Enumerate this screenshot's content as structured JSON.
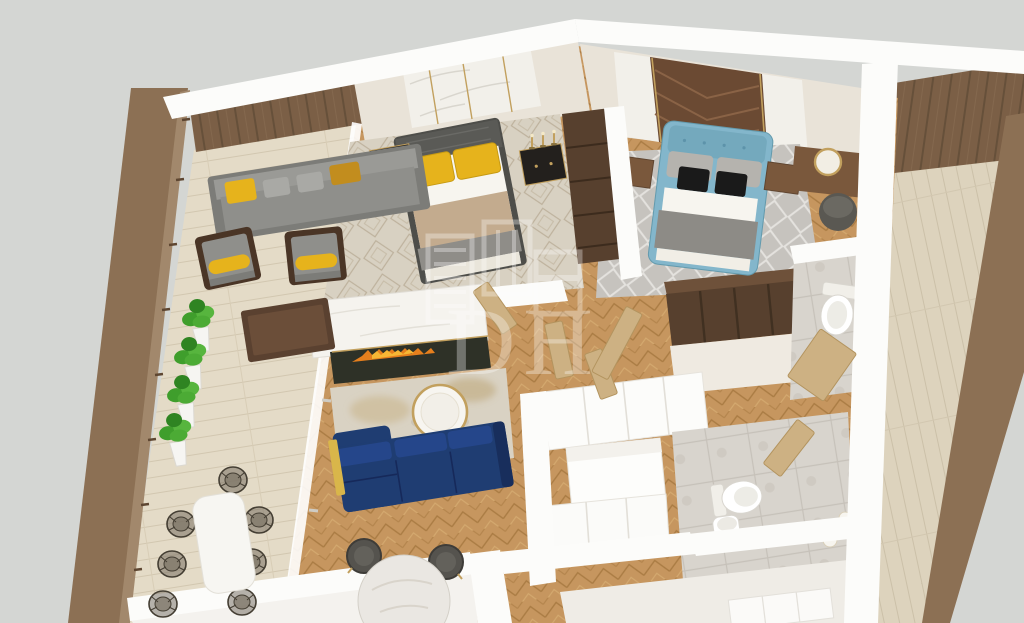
{
  "watermark": {
    "letters": "DH",
    "icon": "building-logo-icon"
  },
  "colors": {
    "background": "#d4d6d3",
    "wall_white": "#fcfcfa",
    "wall_cream": "#e9e3d8",
    "marble": "#f2f0ea",
    "gold": "#c2a05e",
    "parapet_brown": "#8c7054",
    "panel_brown": "#7b5f46",
    "terrace_wood": "#e4dbc7",
    "interior_wood": "#c6965f",
    "chevron_wood": "#6b4a33",
    "navy_sofa": "#1f3d72",
    "yellow_pillow": "#e6b31c",
    "mustard": "#c28d1e",
    "sofa_gray": "#8f8f8b",
    "blue_bed": "#83b6cb",
    "black_pillow": "#1a1a1a",
    "linen_white": "#f7f5ef",
    "tan_blanket": "#c3ab8e",
    "gray_blanket": "#8f8d88",
    "rug_beige": "#d9d2c3",
    "rug_gray": "#c6c3be",
    "dark_wood": "#57402e",
    "walnut": "#7a583c",
    "door_wood": "#cdb183",
    "tile_gray": "#d8d4cd",
    "fireplace_dark": "#2e3127",
    "flame_orange": "#e67f1d",
    "flame_yellow": "#f7b735",
    "plant_green": "#3f9e2c",
    "planter_white": "#f6f5f2",
    "pouf_gray": "#5a5852",
    "watermark_white": "#ffffff"
  },
  "rooms": [
    {
      "name": "terrace-left",
      "floor": "light wood planks",
      "furniture": [
        "outdoor sofa with yellow and gray pillows",
        "wood coffee table",
        "2 gray armchairs with yellow bolsters",
        "4 potted plants in white planters",
        "white dining table",
        "7 dark wicker chairs"
      ]
    },
    {
      "name": "master-bedroom",
      "floor": "herringbone oak + patterned beige rug",
      "furniture": [
        "double bed with 2 yellow pillows, white sheet, tan blanket, gray throw",
        "2 black nightstands with gold trim",
        "3 candlesticks",
        "tall dark wardrobe",
        "marble feature wall with gold strips"
      ]
    },
    {
      "name": "second-bedroom",
      "floor": "herringbone oak + gray diamond rug",
      "furniture": [
        "blue upholstered double bed with gray and black pillows",
        "2 walnut nightstands",
        "console desk",
        "white round chair with gold rim",
        "dark gray pouf",
        "chevron wood feature wall with marble sides"
      ]
    },
    {
      "name": "living-room",
      "floor": "herringbone oak + beige gold rug",
      "furniture": [
        "navy corner sofa with gold throw",
        "round white coffee table with gold rim",
        "linear fireplace in dark marble with white mantel wall",
        "round marble dining table",
        "2 dark chairs with gold legs"
      ]
    },
    {
      "name": "kitchen",
      "furniture": [
        "white cabinet run",
        "white island",
        "white lower units"
      ]
    },
    {
      "name": "bathroom-upper",
      "floor": "gray stone tile",
      "furniture": [
        "toilet",
        "wood door"
      ]
    },
    {
      "name": "bathroom-lower",
      "floor": "gray stone tile",
      "furniture": [
        "toilet",
        "pedestal sink",
        "wood door",
        "2 white candle vases"
      ]
    },
    {
      "name": "terrace-right",
      "floor": "light wood planks",
      "furniture": [
        "brown paneled wall"
      ]
    }
  ]
}
